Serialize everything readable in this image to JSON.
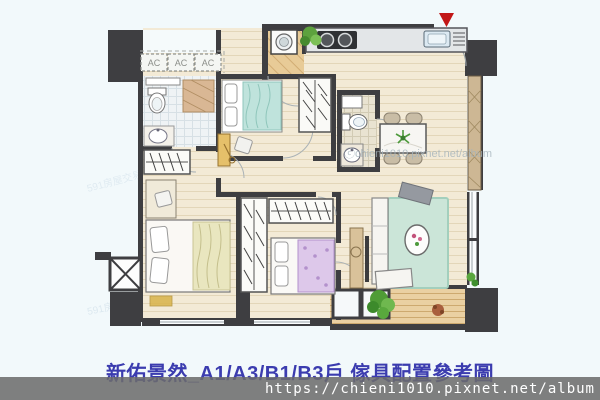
{
  "page": {
    "background": "#f2f9fb"
  },
  "floorplan": {
    "ac_labels": [
      "AC",
      "AC",
      "AC"
    ],
    "entry_marker": "red-triangle",
    "watermark_small": "591房屋交易",
    "colors": {
      "wall": "#3e3e41",
      "wood_floor": "#f3ead6",
      "laundry_floor": "#e8cb97",
      "rug": "#cbe5d8",
      "marker_red": "#c21717",
      "teal_bed": "#bfe3dc",
      "lavender_bed": "#ddc8ea",
      "counter": "#e3e6e8"
    }
  },
  "watermark_center": {
    "text": "ⓒchieni1010.pixnet.net/album"
  },
  "caption": {
    "text": "新佑景然_A1/A3/B1/B3戶 傢具配置參考圖",
    "color": "#3b3caf"
  },
  "url_bar": {
    "text": "https://chieni1010.pixnet.net/album",
    "background": "#6c6c6c",
    "color": "#ffffff"
  }
}
